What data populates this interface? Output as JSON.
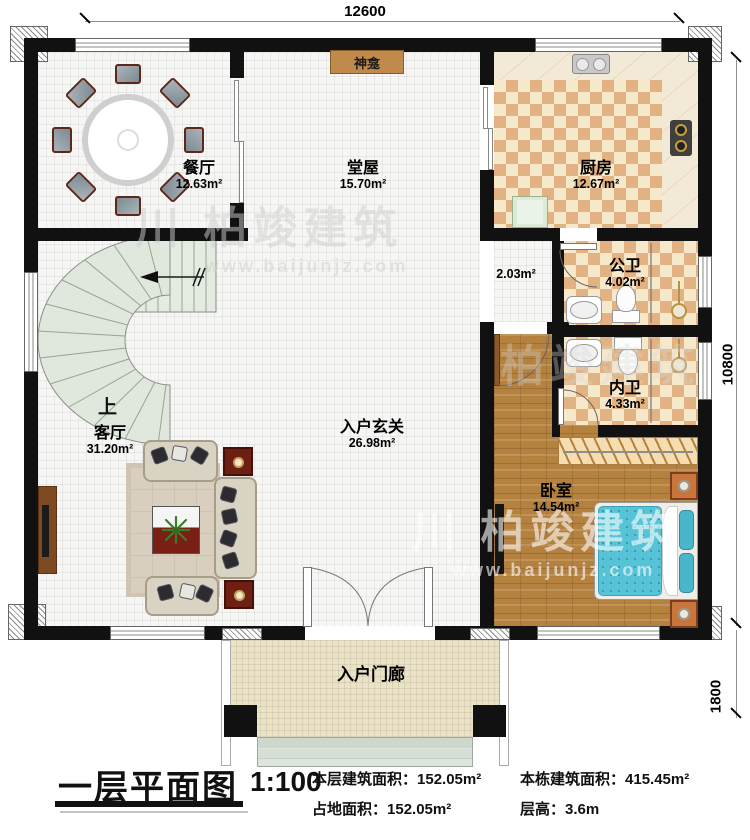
{
  "dimensions": {
    "top": "12600",
    "right_main": "10800",
    "right_porch": "1800"
  },
  "rooms": [
    {
      "id": "dining",
      "name": "餐厅",
      "area": "12.63m²"
    },
    {
      "id": "hall",
      "name": "堂屋",
      "area": "15.70m²"
    },
    {
      "id": "kitchen",
      "name": "厨房",
      "area": "12.67m²"
    },
    {
      "id": "corridor",
      "name": "",
      "area": "2.03m²"
    },
    {
      "id": "public-bath",
      "name": "公卫",
      "area": "4.02m²"
    },
    {
      "id": "private-bath",
      "name": "内卫",
      "area": "4.33m²"
    },
    {
      "id": "living",
      "name": "客厅",
      "area": "31.20m²"
    },
    {
      "id": "foyer",
      "name": "入户玄关",
      "area": "26.98m²"
    },
    {
      "id": "bedroom",
      "name": "卧室",
      "area": "14.54m²"
    },
    {
      "id": "porch",
      "name": "入户门廊",
      "area": ""
    }
  ],
  "labels": {
    "shrine": "神龛",
    "stairs_up": "上"
  },
  "footer": {
    "title": "一层平面图",
    "scale": "1:100",
    "floor_area_label": "本层建筑面积：",
    "floor_area": "152.05m²",
    "land_area_label": "占地面积：",
    "land_area": "152.05m²",
    "total_area_label": "本栋建筑面积：",
    "total_area": "415.45m²",
    "height_label": "层高：",
    "height": "3.6m"
  },
  "watermark": {
    "logo": "川",
    "name": "柏竣建筑",
    "url": "www.baijunjz.com"
  },
  "colors": {
    "wall": "#111111",
    "checker_dark": "#e2b283",
    "checker_light": "#f6e8cb",
    "wood": "#b5813e",
    "stair": "#e0e8dd",
    "mattress": "#56c3d6",
    "accent_red": "#6e1f14",
    "porch": "#ece3c6",
    "shrine": "#c08a4c"
  }
}
